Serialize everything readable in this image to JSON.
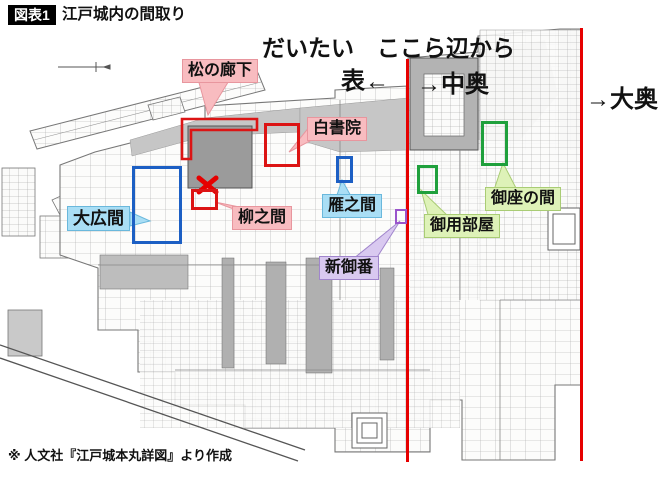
{
  "header": {
    "badge": "図表1",
    "title": "江戸城内の間取り"
  },
  "annotations": {
    "approx_note": "だいたい　ここら辺から",
    "omote": "表←",
    "naka_oku": "→中奥",
    "o_oku": "→大奥"
  },
  "rooms": [
    {
      "name": "matsu-no-roka",
      "label": "松の廊下",
      "label_bg": "#f8bcc0",
      "outline": "#dc1414",
      "outline_shape": "L-corridor"
    },
    {
      "name": "shiro-shoin",
      "label": "白書院",
      "label_bg": "#f8bcc0",
      "outline": "#dc1414",
      "outline_shape": "rect"
    },
    {
      "name": "ohiroma",
      "label": "大広間",
      "label_bg": "#a9def5",
      "outline": "#1c5fc4",
      "outline_shape": "rect"
    },
    {
      "name": "yanagi-no-ma",
      "label": "柳之間",
      "label_bg": "#f8bcc0",
      "outline": "#dc1414",
      "outline_shape": "rect"
    },
    {
      "name": "gan-no-ma",
      "label": "雁之間",
      "label_bg": "#a9def5",
      "outline": "#1c5fc4",
      "outline_shape": "rect"
    },
    {
      "name": "shin-goban",
      "label": "新御番",
      "label_bg": "#d9c9f0",
      "outline": "#9a55cc",
      "outline_shape": "rect"
    },
    {
      "name": "goyo-beya",
      "label": "御用部屋",
      "label_bg": "#def2b8",
      "outline": "#1fa03c",
      "outline_shape": "rect"
    },
    {
      "name": "goza-no-ma",
      "label": "御座の間",
      "label_bg": "#def2b8",
      "outline": "#1fa03c",
      "outline_shape": "rect"
    }
  ],
  "markers": {
    "x_mark_color": "#e60000",
    "divider_line_color": "#e60000",
    "divider_line_count": 2
  },
  "attribution": "※ 人文社『江戸城本丸詳図』より作成"
}
